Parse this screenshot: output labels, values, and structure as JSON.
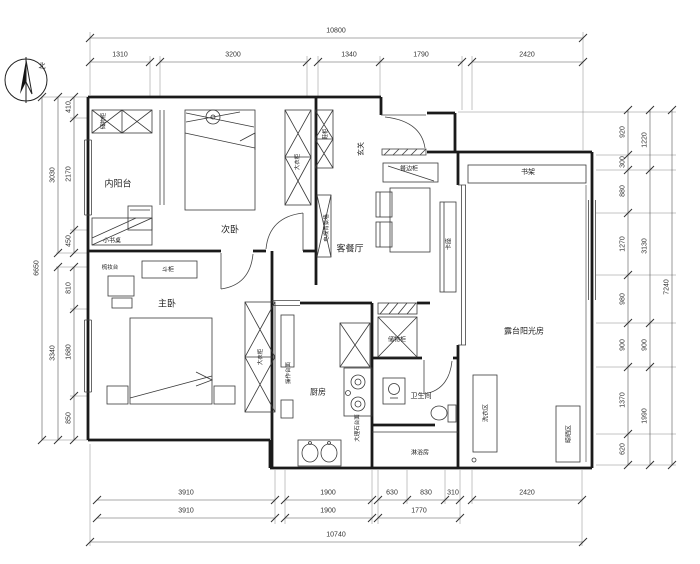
{
  "compass": {
    "north_label": "北"
  },
  "dims": {
    "top": {
      "total": "10800",
      "segments": [
        "1310",
        "3200",
        "1340",
        "1790",
        "2420"
      ]
    },
    "bottom": {
      "row1": [
        "3910",
        "1900",
        "630",
        "830",
        "310",
        "2420"
      ],
      "row2": [
        "3910",
        "1900",
        "1770"
      ],
      "total": "10740"
    },
    "left": {
      "segments": [
        "410",
        "2170",
        "450",
        "810",
        "1680",
        "850"
      ],
      "groups": [
        "3030",
        "3340"
      ],
      "total": "6650"
    },
    "right": {
      "segments": [
        "920",
        "300",
        "880",
        "1270",
        "980",
        "900",
        "1370",
        "620"
      ],
      "groups": [
        "1220",
        "3130",
        "900",
        "1990"
      ],
      "total": "7240"
    }
  },
  "rooms": {
    "inner_balcony": "内阳台",
    "second_bedroom": "次卧",
    "master_bedroom": "主卧",
    "living_dining": "客餐厅",
    "kitchen": "厨房",
    "bathroom": "卫生间",
    "shower_room": "淋浴房",
    "sunroom": "露台阳光房",
    "entry": "玄关"
  },
  "furniture": {
    "storage_cabinet_balcony": "储物柜",
    "small_desk": "小书桌",
    "wardrobe_second": "大衣柜",
    "shoe_cabinet": "鞋柜",
    "tv_wall": "电视背景墙",
    "sideboard": "餐边柜",
    "bench_seat": "卡座",
    "dresser": "梳妆台",
    "chest_drawers": "斗柜",
    "wardrobe_master": "大衣柜",
    "storage_cabinet_kitchen": "储物柜",
    "marble_counter": "大理石台面",
    "work_counter": "操作台面",
    "bookshelf": "书架",
    "laundry_area": "洗衣区",
    "drying_area": "晾晒区"
  }
}
